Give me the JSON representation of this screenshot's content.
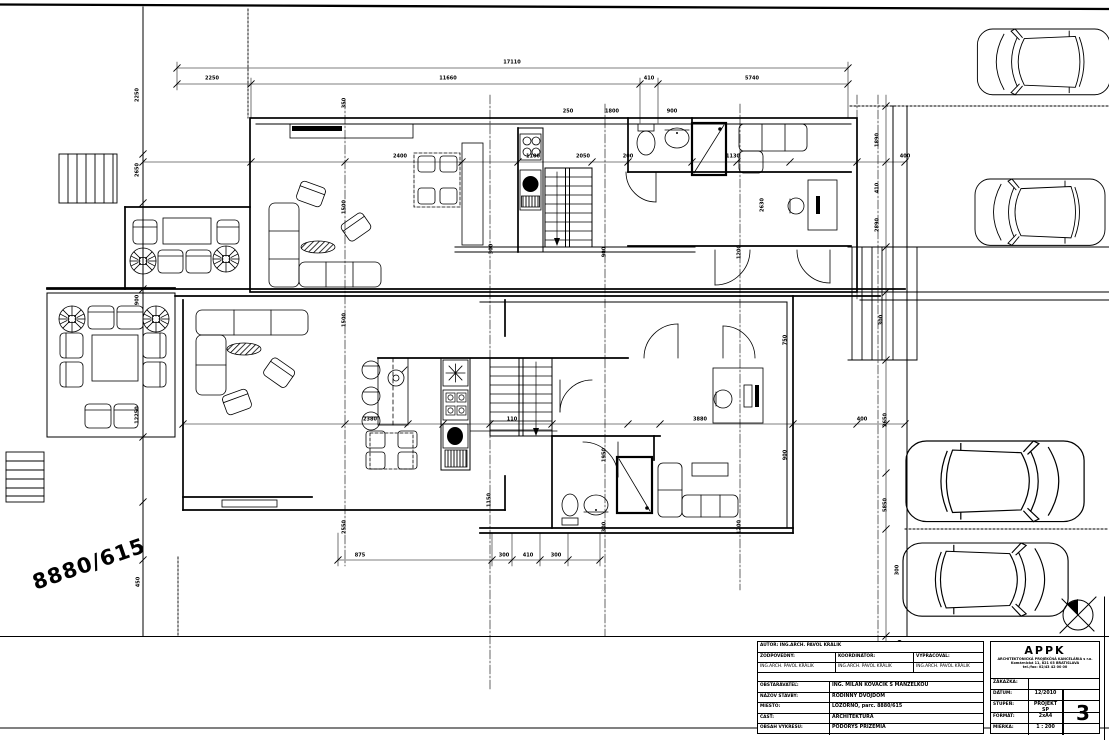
{
  "colors": {
    "line": "#000000",
    "background": "#ffffff"
  },
  "parcel_label": "8880/615",
  "title_block": {
    "author_row": "AUTOR: ING.ARCH. PAVOL KRÁLIK",
    "roles": [
      {
        "label": "ZODPOVEDNÝ:",
        "name": "ING.ARCH. PAVOL KRÁLIK"
      },
      {
        "label": "KOORDINÁTOR:",
        "name": "ING.ARCH. PAVOL KRÁLIK"
      },
      {
        "label": "VYPRACOVAL:",
        "name": "ING.ARCH. PAVOL KRÁLIK"
      }
    ],
    "fields": [
      {
        "label": "OBSTARÁVATEĽ:",
        "value": "ING. MILAN KOVÁČIK S MANŽELKOU"
      },
      {
        "label": "NÁZOV STAVBY:",
        "value": "RODINNÝ DVOJDOM"
      },
      {
        "label": "MIESTO:",
        "value": "LOZORNO, parc. 8880/615"
      },
      {
        "label": "ČASŤ:",
        "value": "ARCHITEKTÚRA"
      },
      {
        "label": "OBSAH VÝKRESU:",
        "value": "PÔDORYS PRÍZEMIA"
      }
    ],
    "office": {
      "logo": "APPK",
      "addr1": "ARCHITEKTONICKÁ PROJEKČNÁ KANCELÁRIA s r.o.",
      "addr2": "Komárnická 11, 821 03 BRATISLAVA",
      "addr3": "tel./fax: 02/43 42 00 00",
      "meta": [
        {
          "label": "ZÁKAZKA:",
          "value": ""
        },
        {
          "label": "DÁTUM:",
          "value": "12/2010"
        },
        {
          "label": "STUPEŇ:",
          "value": "PROJEKT SP"
        },
        {
          "label": "FORMÁT:",
          "value": "2xA4"
        },
        {
          "label": "MIERKA:",
          "value": "1 : 200"
        }
      ],
      "sheet_number": "3"
    }
  },
  "dim_labels": [
    {
      "t": "17110",
      "x": 512,
      "y": 63,
      "r": 0
    },
    {
      "t": "2250",
      "x": 212,
      "y": 79,
      "r": 0
    },
    {
      "t": "11660",
      "x": 448,
      "y": 79,
      "r": 0
    },
    {
      "t": "410",
      "x": 649,
      "y": 79,
      "r": 0
    },
    {
      "t": "5740",
      "x": 752,
      "y": 79,
      "r": 0
    },
    {
      "t": "350",
      "x": 345,
      "y": 103,
      "r": 90
    },
    {
      "t": "250",
      "x": 568,
      "y": 112,
      "r": 0
    },
    {
      "t": "1800",
      "x": 612,
      "y": 112,
      "r": 0
    },
    {
      "t": "900",
      "x": 672,
      "y": 112,
      "r": 0
    },
    {
      "t": "2400",
      "x": 400,
      "y": 157,
      "r": 0
    },
    {
      "t": "1100",
      "x": 533,
      "y": 157,
      "r": 0
    },
    {
      "t": "2050",
      "x": 583,
      "y": 157,
      "r": 0
    },
    {
      "t": "200",
      "x": 628,
      "y": 157,
      "r": 0
    },
    {
      "t": "1130",
      "x": 733,
      "y": 157,
      "r": 0
    },
    {
      "t": "400",
      "x": 905,
      "y": 157,
      "r": 0
    },
    {
      "t": "2650",
      "x": 138,
      "y": 170,
      "r": 90
    },
    {
      "t": "2250",
      "x": 138,
      "y": 95,
      "r": 90
    },
    {
      "t": "900",
      "x": 138,
      "y": 300,
      "r": 90
    },
    {
      "t": "12250",
      "x": 138,
      "y": 415,
      "r": 90
    },
    {
      "t": "450",
      "x": 139,
      "y": 582,
      "r": 90
    },
    {
      "t": "1500",
      "x": 345,
      "y": 207,
      "r": 90
    },
    {
      "t": "2630",
      "x": 763,
      "y": 205,
      "r": 90
    },
    {
      "t": "300",
      "x": 492,
      "y": 249,
      "r": 90
    },
    {
      "t": "900",
      "x": 605,
      "y": 252,
      "r": 90
    },
    {
      "t": "1200",
      "x": 740,
      "y": 252,
      "r": 90
    },
    {
      "t": "1890",
      "x": 878,
      "y": 140,
      "r": 90
    },
    {
      "t": "410",
      "x": 878,
      "y": 188,
      "r": 90
    },
    {
      "t": "2890",
      "x": 878,
      "y": 225,
      "r": 90
    },
    {
      "t": "300",
      "x": 882,
      "y": 320,
      "r": 90
    },
    {
      "t": "2650",
      "x": 886,
      "y": 420,
      "r": 90
    },
    {
      "t": "5850",
      "x": 886,
      "y": 505,
      "r": 90
    },
    {
      "t": "1500",
      "x": 345,
      "y": 320,
      "r": 90
    },
    {
      "t": "2550",
      "x": 345,
      "y": 527,
      "r": 90
    },
    {
      "t": "1150",
      "x": 490,
      "y": 500,
      "r": 90
    },
    {
      "t": "300",
      "x": 605,
      "y": 527,
      "r": 90
    },
    {
      "t": "1950",
      "x": 605,
      "y": 455,
      "r": 90
    },
    {
      "t": "1200",
      "x": 740,
      "y": 527,
      "r": 90
    },
    {
      "t": "750",
      "x": 786,
      "y": 340,
      "r": 90
    },
    {
      "t": "900",
      "x": 786,
      "y": 455,
      "r": 90
    },
    {
      "t": "2380",
      "x": 370,
      "y": 420,
      "r": 0
    },
    {
      "t": "110",
      "x": 512,
      "y": 420,
      "r": 0
    },
    {
      "t": "3880",
      "x": 700,
      "y": 420,
      "r": 0
    },
    {
      "t": "400",
      "x": 862,
      "y": 420,
      "r": 0
    },
    {
      "t": "875",
      "x": 360,
      "y": 556,
      "r": 0
    },
    {
      "t": "300",
      "x": 504,
      "y": 556,
      "r": 0
    },
    {
      "t": "410",
      "x": 528,
      "y": 556,
      "r": 0
    },
    {
      "t": "300",
      "x": 556,
      "y": 556,
      "r": 0
    },
    {
      "t": "300",
      "x": 898,
      "y": 570,
      "r": 90
    },
    {
      "t": "450",
      "x": 901,
      "y": 645,
      "r": 90
    }
  ]
}
